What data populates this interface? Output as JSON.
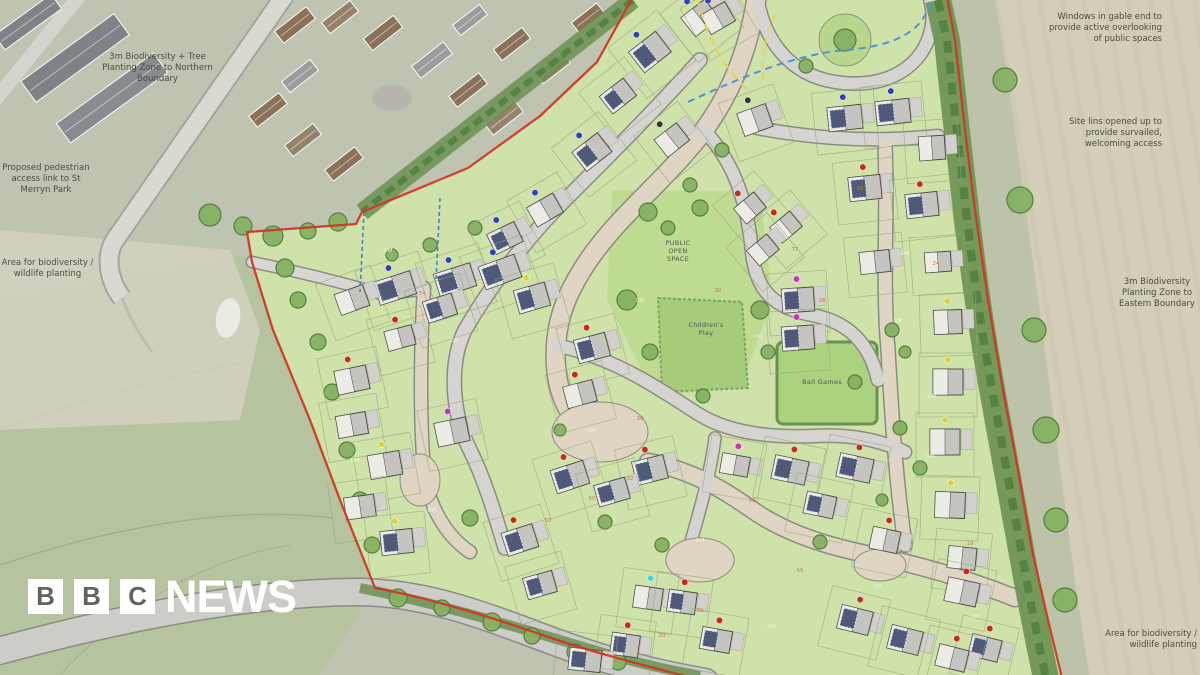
{
  "page": {
    "description": "Illustrative masterplan of a proposed housing development overlaid on an aerial photograph",
    "logo": {
      "blocks": [
        "B",
        "B",
        "C"
      ],
      "wordmark": "NEWS"
    }
  },
  "map": {
    "annotations": {
      "northern_planting": "3m Biodiversity + Tree\nPlanting Zone to Northern\nBoundary",
      "pedestrian_link": "Proposed pedestrian\naccess link to St\nMerryn Park",
      "biodiversity_west": "Area for biodiversity /\nwildlife planting",
      "windows_gable": "Windows in gable end to\nprovide active overlooking\nof public spaces",
      "site_lines": "Site lins opened up to\nprovide survailed,\nwelcoming access",
      "eastern_planting": "3m Biodiversity\nPlanting Zone to\nEastern Boundary",
      "biodiversity_se": "Area for biodiversity /\nwildlife planting"
    },
    "area_labels": {
      "public_open_space": "PUBLIC\nOPEN\nSPACE",
      "childrens_play": "Children's\nPlay",
      "ball_games": "Ball Games"
    },
    "plot_codes": {
      "om": "OM",
      "numbers": [
        "30",
        "30",
        "50",
        "50",
        "50",
        "55",
        "20",
        "26",
        "26",
        "74",
        "77",
        "24",
        "19",
        "58",
        "32"
      ]
    },
    "colors": {
      "site_green": "#cfe2a9",
      "open_space_green": "#bcd98e",
      "play_green": "#a6cc7b",
      "road_gray": "#d5d4d0",
      "road_beige": "#e0d5c2",
      "road_edge": "#8b8b83",
      "boundary_red": "#d03726",
      "hedge_green": "#6a9150",
      "tree_green": "#86b262",
      "house_gray": "#c5c4c1",
      "roof_white": "#edebe6",
      "solar_blue": "#4e5a78",
      "markers": {
        "red": "#c9281c",
        "blue": "#2f3fc0",
        "yellow": "#e0cf3c",
        "magenta": "#c633c0",
        "cyan": "#45d5d8",
        "black": "#333333"
      },
      "plot_code_green": "#eef5d4",
      "plot_number_orange": "#c27a36"
    }
  }
}
